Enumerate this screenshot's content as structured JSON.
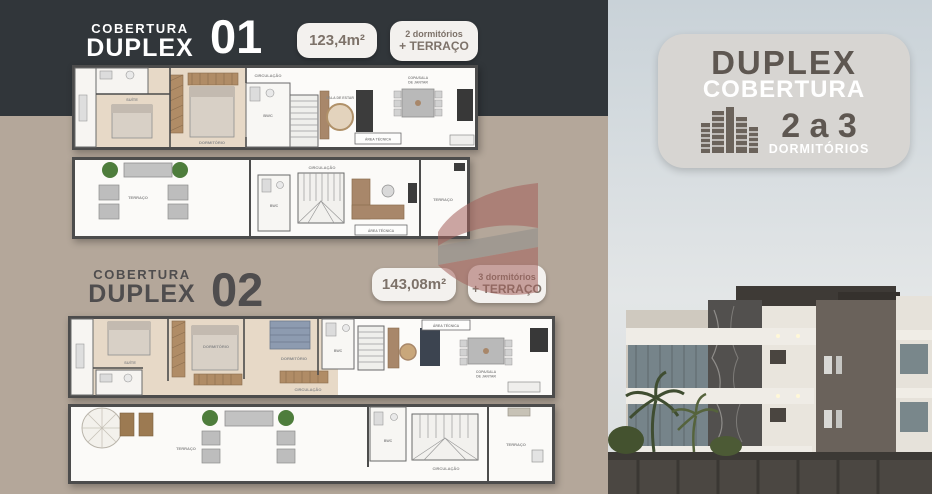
{
  "sections": [
    {
      "title_top": "COBERTURA",
      "title_bottom": "DUPLEX",
      "number": "01",
      "area_badge": "123,4m²",
      "rooms_badge_line1": "2 dormitórios",
      "rooms_badge_line2": "+ TERRAÇO"
    },
    {
      "title_top": "COBERTURA",
      "title_bottom": "DUPLEX",
      "number": "02",
      "area_badge": "143,08m²",
      "rooms_badge_line1": "3 dormitórios",
      "rooms_badge_line2": "+ TERRAÇO"
    }
  ],
  "side_badge": {
    "line1": "DUPLEX",
    "line2": "COBERTURA",
    "range": "2 a 3",
    "line3": "DORMITÓRIOS"
  },
  "plan_labels": {
    "circulacao": "CIRCULAÇÃO",
    "dormitorio": "DORMITÓRIO",
    "suite": "SUÍTE",
    "bwc": "BWC",
    "sala_estar": "SALA DE ESTAR",
    "copa_line1": "COPA/SALA",
    "copa_line2": "DE JANTAR",
    "area_tecnica": "ÁREA TÉCNICA",
    "terraco": "TERRAÇO"
  },
  "colors": {
    "header_band": "#31363a",
    "left_background": "#b4a79a",
    "pill_background": "#f3f1ee",
    "pill_text": "#7d7269",
    "title_light": "#ffffff",
    "title_dark": "#4f4d4e",
    "side_badge_background": "#d7d5d2",
    "side_badge_text_dark": "#5e5751",
    "watermark_red": "#a4615c",
    "watermark_gray": "#908e8b",
    "sky": "#c9d2d8"
  }
}
